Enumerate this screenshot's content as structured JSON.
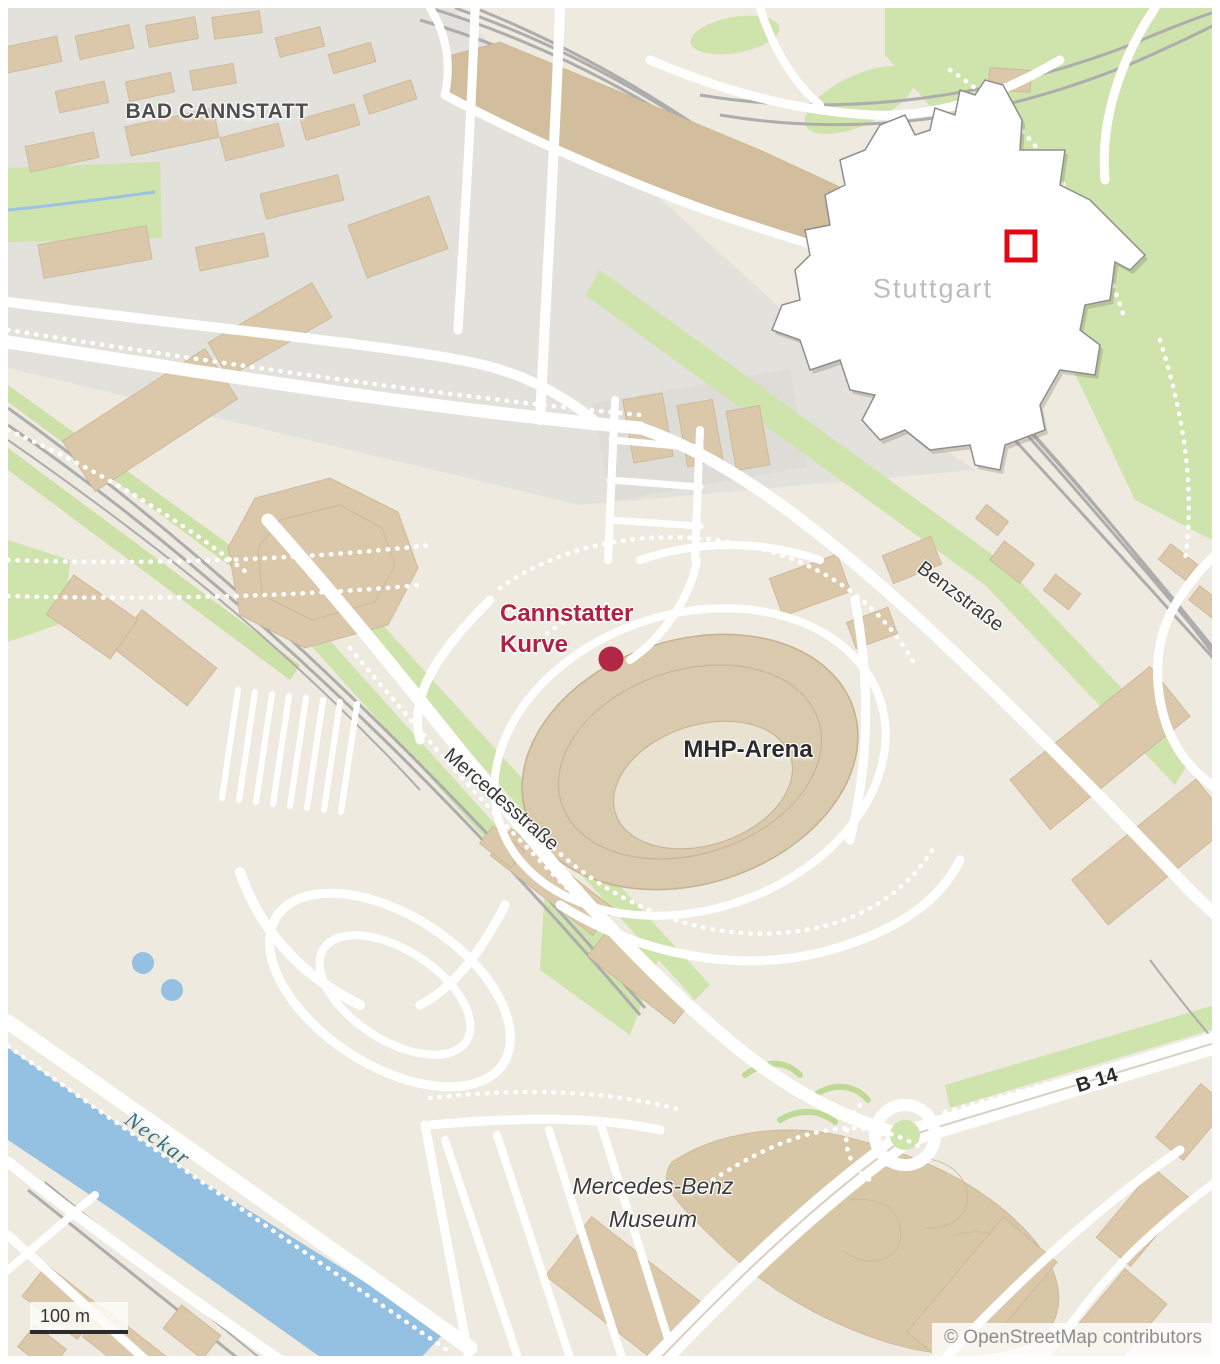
{
  "labels": {
    "district": "BAD CANNSTATT",
    "marker": {
      "line1": "Cannstatter",
      "line2": "Kurve"
    },
    "stadium": "MHP-Arena",
    "street_mercedes": "Mercedesstraße",
    "street_benz": "Benzstraße",
    "road_b14": "B 14",
    "river": "Neckar",
    "museum": {
      "line1": "Mercedes-Benz",
      "line2": "Museum"
    }
  },
  "inset": {
    "city": "Stuttgart"
  },
  "scale": {
    "label": "100 m"
  },
  "attribution": {
    "text": "© OpenStreetMap contributors"
  },
  "colors": {
    "background": "#efeae0",
    "district_zone": "#e3e1dc",
    "building": "#dbc7a9",
    "factory": "#d2be9d",
    "green": "#cfe3ad",
    "river_blue": "#94c1e1",
    "rail_gray": "#adadad",
    "road_white": "#ffffff",
    "marker_red": "#b22646",
    "label_red": "#b02045",
    "inset_square_red": "#e30613"
  }
}
